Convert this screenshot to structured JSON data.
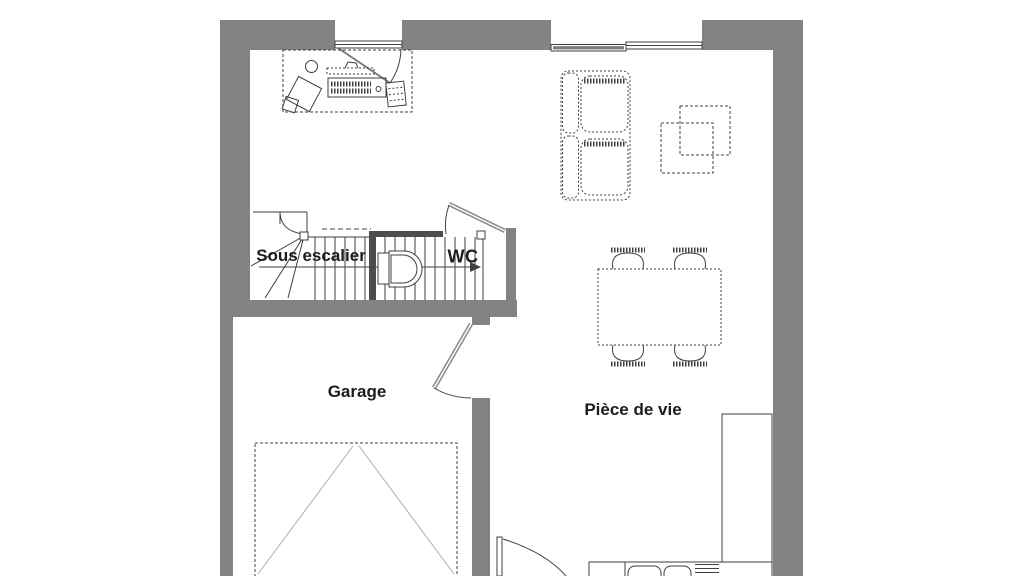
{
  "meta": {
    "type": "architectural-floor-plan",
    "level": "ground-floor"
  },
  "colors": {
    "background": "#ffffff",
    "wall": "#838383",
    "wall_dark": "#4d4d4d",
    "line": "#3f3f3f",
    "line_light": "#b0b0b0",
    "door": "#8a8a8a",
    "text": "#1c1c1c"
  },
  "rooms": {
    "sous_escalier": {
      "label": "Sous escalier"
    },
    "wc": {
      "label": "WC"
    },
    "garage": {
      "label": "Garage"
    },
    "piece_de_vie": {
      "label": "Pièce de vie"
    }
  },
  "fixtures": {
    "office_corner": [
      "desk",
      "office-chair",
      "computer-monitor",
      "keyboard",
      "waste-bin"
    ],
    "living_area": [
      "sofa",
      "coffee-table",
      "dining-table",
      "dining-chairs-x4"
    ],
    "kitchen_strip": [
      "counter-right",
      "counter-bottom",
      "double-sink",
      "cooktop"
    ],
    "wc": [
      "toilet"
    ],
    "circulation": [
      "staircase-with-up-arrow",
      "glazed-door-top",
      "sliding-bay-window",
      "wc-door",
      "garage-door",
      "entry-door",
      "garage-gate-dashed-zone"
    ]
  }
}
